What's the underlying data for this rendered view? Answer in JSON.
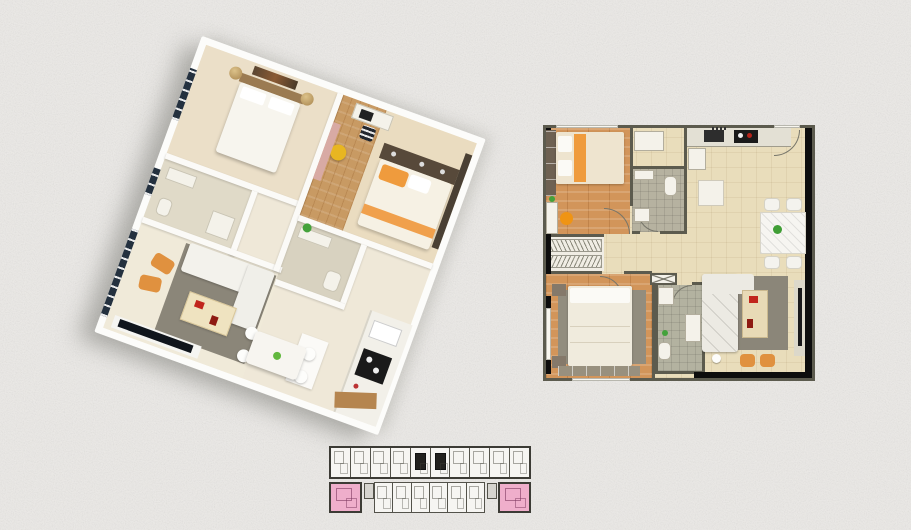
{
  "scene": {
    "type": "apartment floor plan collage",
    "views": [
      {
        "id": "plan-3d",
        "kind": "3d-isometric-apartment-render",
        "rotation_deg": 20
      },
      {
        "id": "plan-2d",
        "kind": "2d-top-down-floor-plan"
      },
      {
        "id": "keyplan",
        "kind": "building-key-plan",
        "highlighted_units": 2
      }
    ]
  },
  "colors": {
    "page_bg": "#eceae7",
    "wall_dark": "#5c5b4e",
    "wall_black": "#0d0d0d",
    "floor_beige": "#e9ddbb",
    "floor_wood": "#d2955a",
    "bath_tile": "#b6b2a0",
    "rug_gray": "#8b8679",
    "sofa_white": "#eceae3",
    "accent_orange": "#e0913f",
    "accent_red": "#c1251c",
    "accent_green": "#44a23b",
    "marble_white": "#f6f5f1",
    "appliance_black": "#1a1a1a",
    "glass_dark": "#24313f",
    "curtain_pink": "#d8aaa4",
    "bed_orange": "#ef9b3d",
    "keyplan_pink": "#efaecb",
    "keyplan_line": "#53524a"
  },
  "plan2d": {
    "rooms": [
      "bedroom-1",
      "bedroom-2",
      "bathroom-1",
      "bathroom-2",
      "loggia-drying-yard",
      "kitchen",
      "dining-area",
      "living-room",
      "entry-corridor"
    ],
    "furniture": [
      "double-bed-1",
      "double-bed-2",
      "wardrobe",
      "desk-with-orange-chair",
      "kitchen-counter-with-cooktop",
      "fridge",
      "dining-table-4-chairs",
      "l-shaped-sofa",
      "coffee-table",
      "orange-stools",
      "tv-console",
      "toilet",
      "washbasin",
      "washer"
    ]
  },
  "plan3d": {
    "rooms": [
      "bedroom-1",
      "bedroom-2",
      "bathroom",
      "ensuite",
      "living-room",
      "dining-area",
      "kitchen",
      "balcony-glazing"
    ],
    "furniture": [
      "bed-white",
      "bed-orange",
      "desk-chair",
      "yellow-stool",
      "sofa-white",
      "coffee-table-red-decor",
      "orange-armchairs",
      "tv-panel",
      "dining-table-4-seats",
      "kitchen-counter-stove",
      "vanity-plant",
      "wardrobe"
    ]
  },
  "keyplan": {
    "rows": [
      {
        "name": "top",
        "segments": [
          "unit",
          "unit",
          "unit",
          "unit",
          "core",
          "core",
          "unit",
          "unit",
          "unit",
          "unit"
        ]
      },
      {
        "name": "bottom",
        "segments": [
          "highlight",
          "stub",
          "unit",
          "unit",
          "unit",
          "unit",
          "unit",
          "unit",
          "stub",
          "highlight"
        ]
      }
    ]
  }
}
